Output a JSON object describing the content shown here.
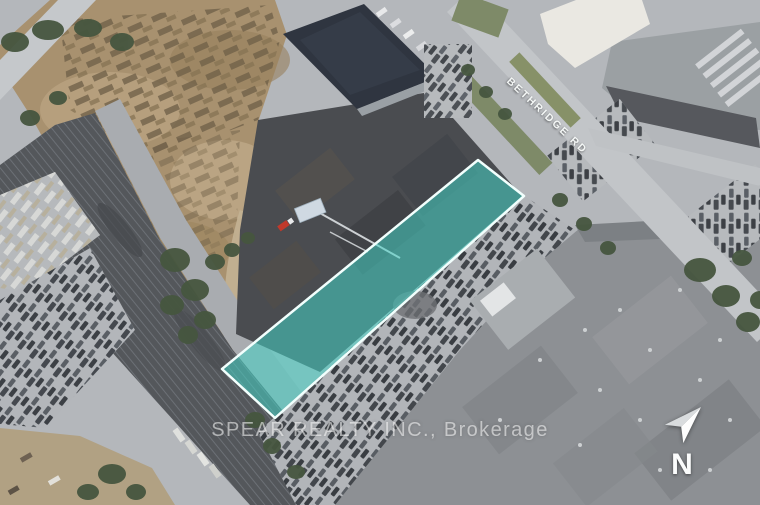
{
  "map": {
    "street_label": "BETHRIDGE RD",
    "watermark": "SPEAR REALTY INC., Brokerage",
    "compass": {
      "label": "N"
    },
    "highlight": {
      "points": "478,160 524,196 275,418 222,369",
      "fill_color": "#43d1c4",
      "fill_opacity": "0.55",
      "border_color": "#f2fffd"
    },
    "scene": {
      "description_labels": [],
      "base_pavement_color": "#b4b7bb",
      "railway_color": "#54575b",
      "dirt_color": "#a8916f",
      "tree_color": "#46563f",
      "dark_roof_color": "#2f3540",
      "industrial_roof_color": "#4a4c50",
      "southeast_roof_color": "#8d9094"
    }
  }
}
